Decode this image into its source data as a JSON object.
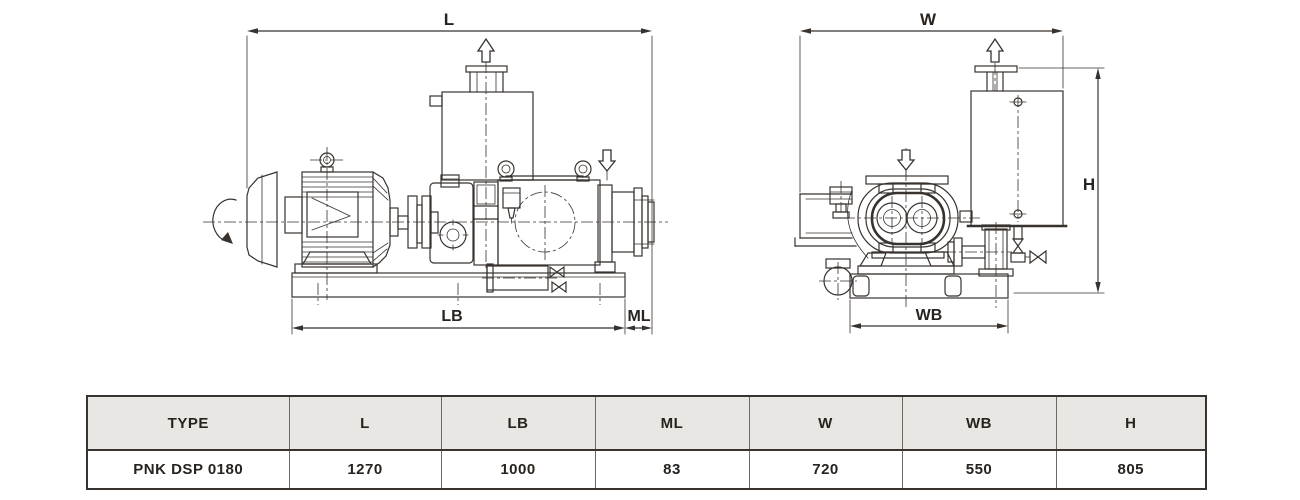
{
  "colors": {
    "line": "#38322e",
    "table_outer_border": "#39332f",
    "table_grid": "#6e6862",
    "table_header_bg": "#e8e7e4",
    "text": "#28231f",
    "background": "#ffffff"
  },
  "drawing": {
    "side_view": {
      "dim_overall_length": "L",
      "dim_base_length": "LB",
      "dim_overhang": "ML"
    },
    "end_view": {
      "dim_overall_width": "W",
      "dim_base_width": "WB",
      "dim_height": "H"
    }
  },
  "table": {
    "headers": [
      "TYPE",
      "L",
      "LB",
      "ML",
      "W",
      "WB",
      "H"
    ],
    "rows": [
      [
        "PNK DSP 0180",
        "1270",
        "1000",
        "83",
        "720",
        "550",
        "805"
      ]
    ]
  }
}
